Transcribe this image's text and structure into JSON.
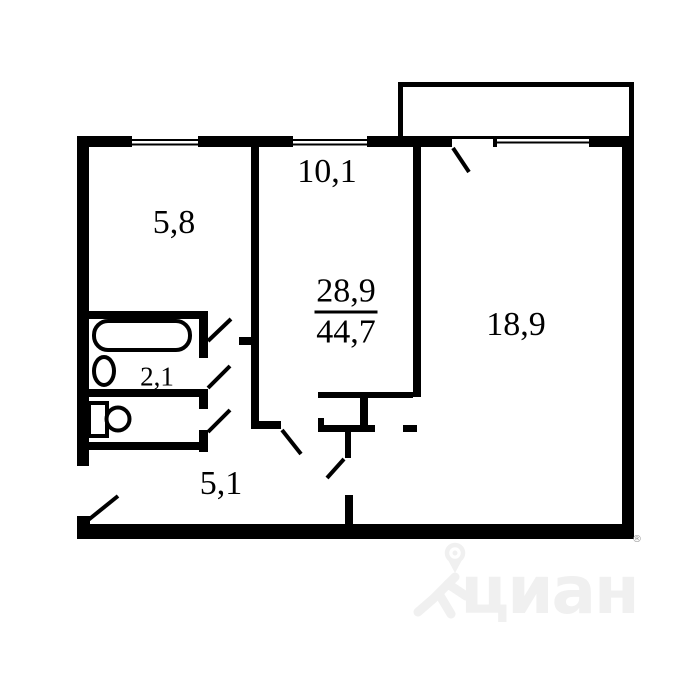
{
  "floor_plan": {
    "rooms": {
      "kitchen": {
        "area": "5,8"
      },
      "room_small": {
        "area": "10,1"
      },
      "room_large": {
        "area": "18,9"
      },
      "bathroom": {
        "area": "2,1"
      },
      "hallway": {
        "area": "5,1"
      }
    },
    "area_summary": {
      "living_area": "28,9",
      "total_area": "44,7"
    },
    "fixtures": [
      "bathtub",
      "sink",
      "toilet"
    ],
    "features": [
      "balcony",
      "windows",
      "door-swings",
      "entrance-door"
    ]
  },
  "watermark": {
    "brand": "циан",
    "registered_mark": "®"
  },
  "colors": {
    "walls": "#000000",
    "background": "#ffffff",
    "watermark": "#f0f0f0",
    "registered_mark": "#999999"
  }
}
